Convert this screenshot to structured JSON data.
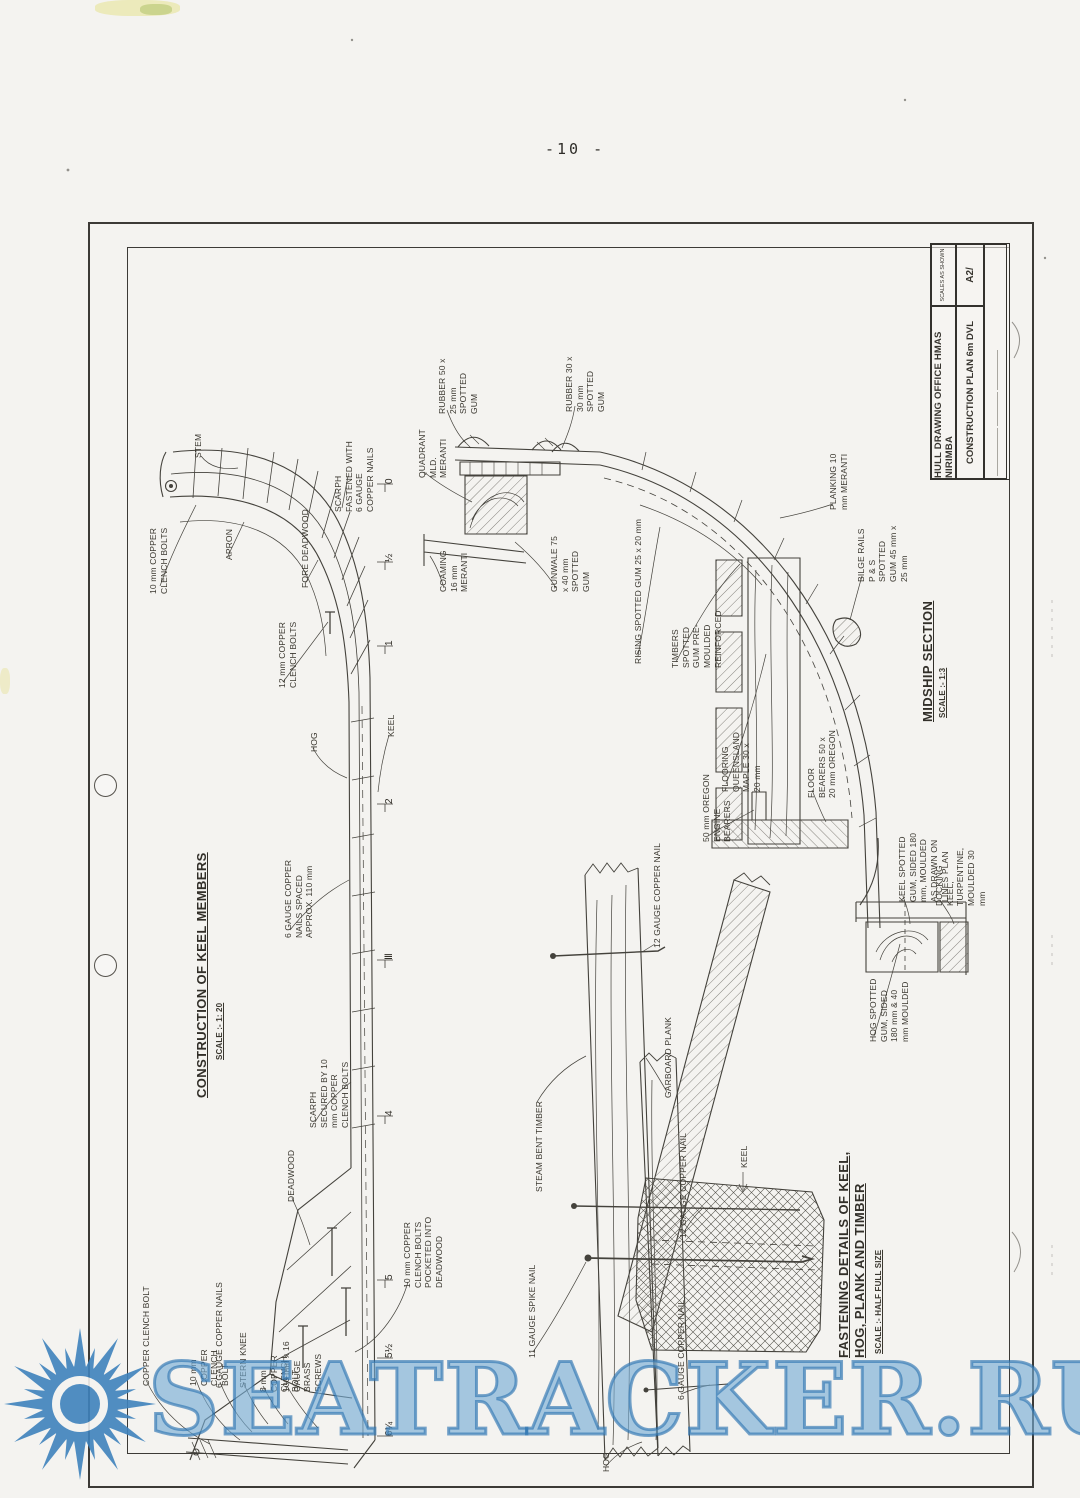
{
  "page": {
    "number": "-10 -"
  },
  "watermark": {
    "text": "SEATRACKER.RU",
    "stroke_color": "#2a6fb0",
    "fill_color": "#9cc4e4"
  },
  "title_block": {
    "office": "HULL DRAWING OFFICE HMAS NIRIMBA",
    "plan": "CONSTRUCTION PLAN 6m DVL",
    "scales": "SCALES AS SHOWN",
    "sheet": "A2/"
  },
  "keel_profile": {
    "title": "CONSTRUCTION OF KEEL MEMBERS",
    "scale": "SCALE :- 1: 20",
    "labels": {
      "stem": "STEM",
      "apron": "APRON",
      "clench_bolts_10": "10 mm COPPER CLENCH BOLTS",
      "fore_deadwood": "FORE DEADWOOD",
      "scarph_fastened": "SCARPH FASTENED WITH 6 GAUGE COPPER NAILS",
      "clench_bolts_12": "12 mm COPPER CLENCH BOLTS",
      "hog": "HOG",
      "keel": "KEEL",
      "nails_spaced": "6 GAUGE COPPER NAILS SPACED APPROX. 110 mm",
      "scarph_secured": "SCARPH SECURED BY 10 mm COPPER CLENCH BOLTS",
      "deadwood": "DEADWOOD",
      "bolts_pocketed": "10 mm COPPER CLENCH BOLTS POCKETED INTO DEADWOOD",
      "clench_bolt": "COPPER CLENCH BOLT",
      "clench_bolt_10": "10 mm COPPER CLENCH BOLT",
      "copper_nails_6": "6 GAUGE COPPER NAILS",
      "stern_knee": "STERN KNEE",
      "clench_bolt_8": "8 mm COPPER CLENCH BOLT",
      "brass_screws": "100 mm x 16 GAUGE BRASS SCREWS"
    },
    "stations": [
      "0",
      "½",
      "1",
      "2",
      "Ⅲ",
      "4",
      "5",
      "5½",
      "6¼"
    ]
  },
  "midship": {
    "title": "MIDSHIP SECTION",
    "scale": "SCALE :- 1:3",
    "labels": {
      "rubber_50": "RUBBER 50 x 25 mm SPOTTED GUM",
      "rubber_30": "RUBBER 30 x 30 mm SPOTTED GUM",
      "quadrant": "QUADRANT MLD. MERANTI",
      "coaming": "COAMING 16 mm MERANTI",
      "gunwale": "GUNWALE 75 x 40 mm SPOTTED GUM",
      "rising": "RISING SPOTTED GUM 25 x 20 mm",
      "timbers": "TIMBERS SPOTTED GUM PRE-MOULDED REINFORCED",
      "flooring": "FLOORING QUEENSLAND MAPLE 30 x 20 mm",
      "planking": "PLANKING 10 mm MERANTI",
      "bilge_rails": "BILGE RAILS P & S SPOTTED GUM 45 mm x 25 mm",
      "engine_bearers": "50 mm OREGON ENGINE BEARERS",
      "floor_bearers": "FLOOR BEARERS 50 x 20 mm OREGON",
      "keel_spotted": "KEEL SPOTTED GUM, SIDED 180 mm, MOULDED AS DRAWN ON LINES PLAN",
      "docking_keel": "DOCKING KEEL, TURPENTINE, MOULDED 30 mm",
      "hog_spotted": "HOG SPOTTED GUM, SIDED 180 mm & 40 mm MOULDED"
    }
  },
  "fastening": {
    "title": "FASTENING DETAILS OF KEEL, HOG, PLANK AND TIMBER",
    "scale": "SCALE :- HALF FULL SIZE",
    "labels": {
      "steam_bent": "STEAM BENT TIMBER",
      "nail_12a": "12 GAUGE COPPER NAIL",
      "garboard": "GARBOARD PLANK",
      "nail_12b": "12 GAUGE COPPER NAIL",
      "keel_arrow": "KEEL",
      "spike_11": "11 GAUGE SPIKE NAIL",
      "nail_6": "6 GAUGE COPPER NAIL",
      "hog": "HOG"
    }
  }
}
